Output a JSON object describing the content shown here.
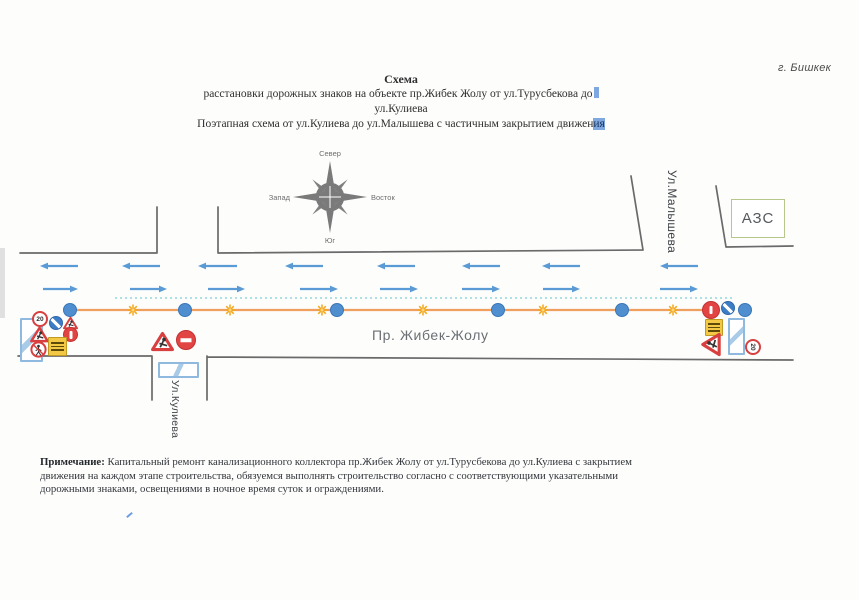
{
  "page": {
    "city_label": "г. Бишкек"
  },
  "title": {
    "line1": "Схема",
    "line2": "расстановки дорожных знаков на объекте пр.Жибек Жолу от ул.Турусбекова до",
    "line3": "ул.Кулиева",
    "line4_pre": "Поэтапная схема от ул.Кулиева до ул.Малышева с частичным закрытием движен",
    "line4_hl": "ия"
  },
  "compass": {
    "north": "Север",
    "south": "Юг",
    "west": "Запад",
    "east": "Восток"
  },
  "labels": {
    "road_name": "Пр. Жибек-Жолу",
    "street_kulieva": "Ул.Кулиева",
    "street_malysheva": "Ул.Малышева",
    "azs": "АЗС"
  },
  "signs": {
    "speed_limit": "20"
  },
  "note": {
    "label": "Примечание:",
    "text": " Капитальный ремонт канализационного коллектора пр.Жибек Жолу от ул.Турусбекова до ул.Кулиева с закрытием движения на каждом этапе строительства, обязуемся выполнять строительство согласно  с соответствующими указательными дорожными знаками, освещениями в ночное время суток и ограждениями."
  },
  "diagram": {
    "colors": {
      "arrow": "#5b9bd5",
      "work_line": "#ef9f5e",
      "dot_fill": "#4f8fd0",
      "dot_border": "#3a76b8",
      "star": "#f2a71b",
      "star_center": "#fbd67e",
      "dashed": "#7ccfd6",
      "road_edge": "#6a6a6a"
    },
    "arrows": {
      "left_y": 266,
      "right_y": 289,
      "left": [
        [
          40,
          78
        ],
        [
          122,
          160
        ],
        [
          198,
          237
        ],
        [
          285,
          323
        ],
        [
          377,
          415
        ],
        [
          462,
          500
        ],
        [
          542,
          580
        ],
        [
          660,
          698
        ]
      ],
      "right": [
        [
          43,
          78
        ],
        [
          130,
          167
        ],
        [
          208,
          245
        ],
        [
          300,
          338
        ],
        [
          380,
          418
        ],
        [
          462,
          500
        ],
        [
          543,
          580
        ],
        [
          660,
          698
        ]
      ]
    },
    "work_line": {
      "x1": 70,
      "x2": 704,
      "y": 310
    },
    "dashed_line": {
      "x1": 115,
      "x2": 732,
      "y": 298
    },
    "dots": [
      70,
      185,
      337,
      498,
      622,
      745
    ],
    "stars": [
      133,
      230,
      322,
      423,
      543,
      673
    ]
  }
}
